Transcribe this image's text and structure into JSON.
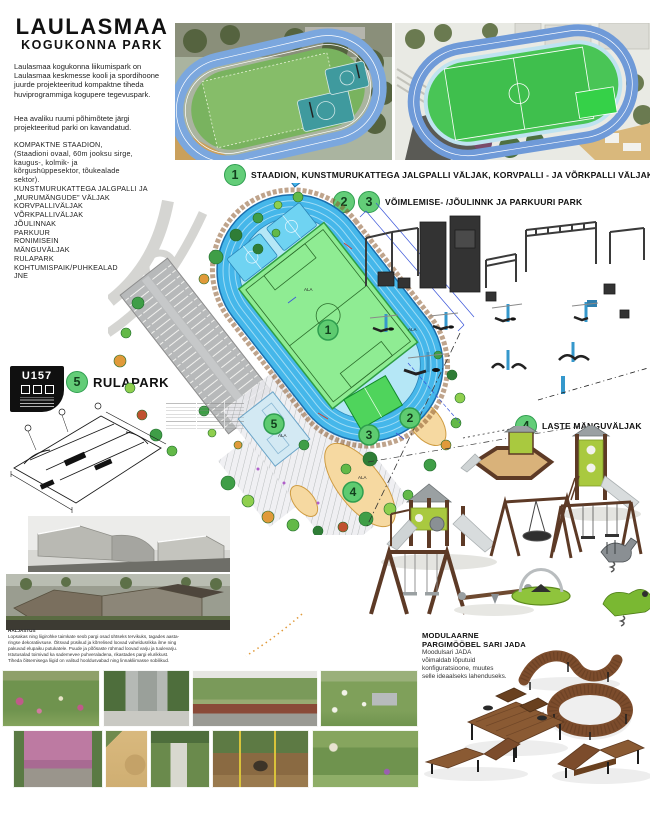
{
  "poster": {
    "title_line1": "LAULASMAA",
    "title_line2": "KOGUKONNA PARK",
    "intro_p1": "Laulasmaa kogukonna liikumispark on Laulasmaa keskmesse kooli ja spordihoone juurde projekteeritud kompaktne tiheda huviprogrammiga kogupere tegevuspark.",
    "intro_p2": "Hea avaliku ruumi põhimõtete järgi projekteeritud parki on kavandatud.",
    "features": [
      "KOMPAKTNE STAADION,",
      "(Staadioni ovaal, 60m jooksu sirge,",
      "kaugus-, kolmik- ja",
      "kõrgushüppesektor, tõukealade",
      "sektor).",
      "KUNSTMURUKATTEGA JALGPALLI JA",
      "„MURUMÄNGUDE” VÄLJAK",
      "KORVPALLIVÄLJAK",
      "VÕRKPALLIVÄLJAK",
      "JÕULINNAK",
      "PARKUUR",
      "RONIMISEIN",
      "MÄNGUVÄLJAK",
      "RULAPARK",
      "KOHTUMISPAIK/PUHKEALAD",
      "JNE"
    ]
  },
  "sections": {
    "s1": {
      "num": "1",
      "text": "STAADION, KUNSTMURUKATTEGA JALGPALLI VÄLJAK, KORVPALLI - JA VÕRKPALLI VÄLJAK"
    },
    "s23": {
      "num_a": "2",
      "num_b": "3",
      "text": "VÕIMLEMISE- /JÕULINNK JA PARKUURI PARK"
    },
    "s4": {
      "num": "4",
      "text": "LASTE MÄNGUVÄLJAK"
    },
    "s5": {
      "num": "5",
      "text": "RULAPARK"
    }
  },
  "logo": {
    "code": "U157"
  },
  "plan": {
    "area_label": "ALA",
    "markers": {
      "m1": "1",
      "m2": "2",
      "m3": "3",
      "m4": "4",
      "m5": "5"
    }
  },
  "planting_note": {
    "lines": [
      "HALJASTUS",
      "Lopsakas ning liigirohke taimkate seob pargi osad ühtseks tervikuks, tagades aasta-",
      "ringse dekoratiivsuse. Õitsvad püsikud ja kõrrelised loovad vaheldusrikka ilme ning",
      "pakuvad elupaiku putukatele. Puude ja põõsaste rühmad loovad varju ja tuulevarju.",
      "Istutusalad toimivad ka sademevee puhveraladena, rikastades pargi elurikkust.",
      "Tiheda õitsemisega liigid on valitud hooldusvabad ning linnakliimasse sobilikud."
    ]
  },
  "furniture": {
    "heading_line1": "MODULAARNE",
    "heading_line2": "PARGIMÖÖBEL SARI JADA",
    "body_lines": [
      "Moodulsari JADA",
      "võimaldab lõputuid",
      "konfiguratsioone, muutes",
      "selle ideaalseks lahenduseks."
    ]
  },
  "colors": {
    "accent_green": "#63cd78",
    "track_blue": "#45b7ea",
    "field_green": "#8fec93",
    "wood_brown": "#7c4c2c"
  }
}
